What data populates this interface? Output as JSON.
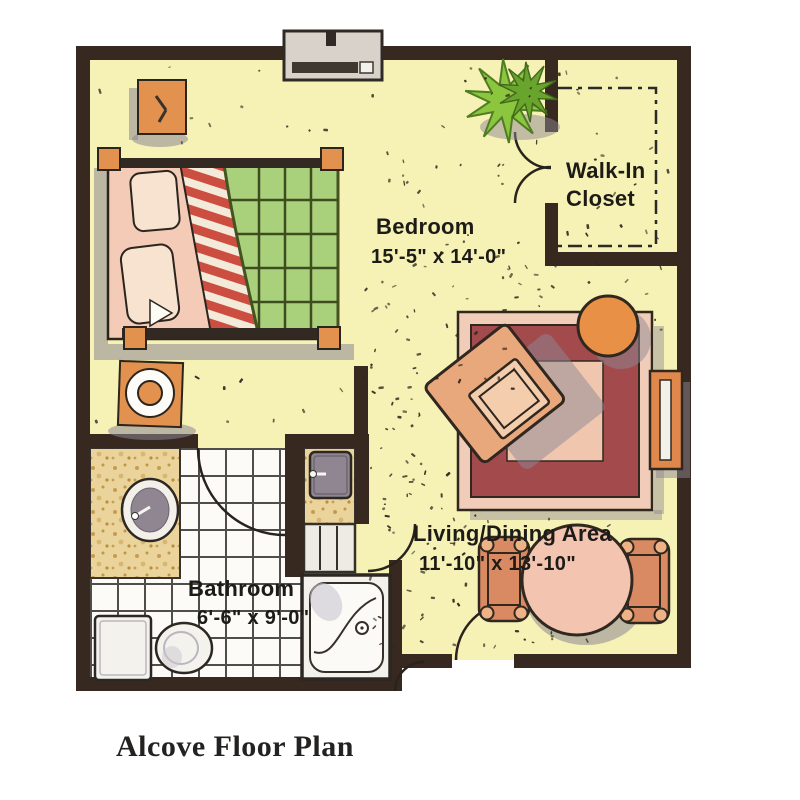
{
  "title": "Alcove Floor Plan",
  "plan": {
    "rooms": {
      "bedroom": {
        "name": "Bedroom",
        "dimensions": "15'-5\" x 14'-0\""
      },
      "walk_in_closet": {
        "name_line1": "Walk-In",
        "name_line2": "Closet"
      },
      "living_dining": {
        "name": "Living/Dining Area",
        "dimensions": "11'-10\" x 13'-10\""
      },
      "bathroom": {
        "name": "Bathroom",
        "dimensions": "6'-6\" x 9'-0\""
      }
    },
    "colors": {
      "wall": "#37291f",
      "floor": "#f6f1b4",
      "tile_floor": "#fcfbf7",
      "counter": "#ead49b",
      "rug_border": "#f1ccb8",
      "rug_band": "#a34a4c",
      "rug_center": "#f1c6ae",
      "furniture_orange": "#e2924e",
      "furniture_salmon": "#e9a87c",
      "quilt_green": "#a9d17c",
      "stripe_red": "#cb4e40",
      "plant_green": "#8cc63f",
      "shadow": "#8d8793"
    }
  }
}
